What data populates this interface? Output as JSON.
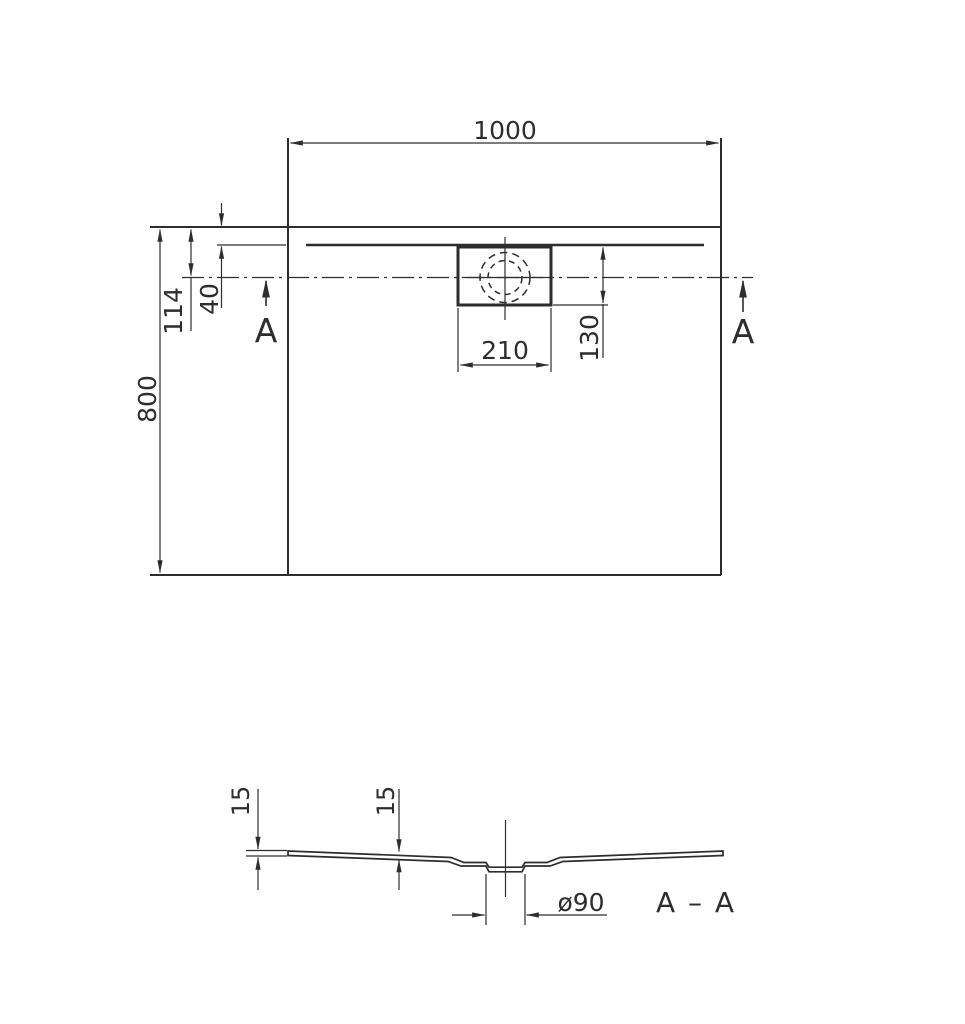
{
  "drawing": {
    "type": "shower-tray technical drawing, plan view and section view",
    "line_color": "#2d2d2d",
    "background": "#ffffff",
    "plan_view": {
      "length_label": "1000",
      "width_label": "800",
      "drain_center_offset_label": "114",
      "rim_offset_label": "40",
      "drain_cover_width_label": "210",
      "drain_cover_depth_label": "130",
      "section_marker_left": "A",
      "section_marker_right": "A"
    },
    "section_view": {
      "title": "A – A",
      "edge_thickness_label": "15",
      "slope_thickness_label": "15",
      "drain_diameter_label": "ø90"
    }
  }
}
